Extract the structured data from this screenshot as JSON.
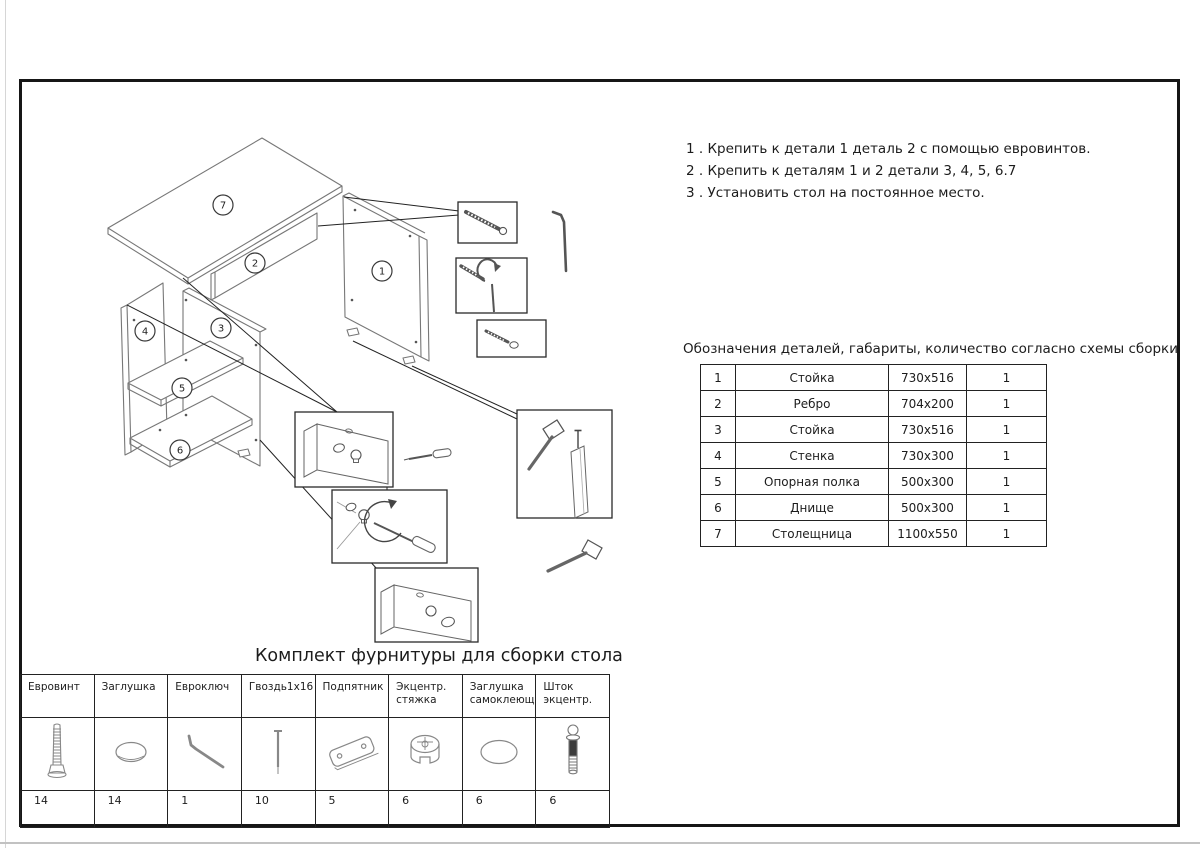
{
  "sheet": {
    "background": "#ffffff",
    "frame_color": "#161616"
  },
  "instructions": {
    "steps": [
      "1 . Крепить к детали 1 деталь 2 с помощью евровинтов.",
      "2 . Крепить к деталям 1 и 2 детали 3, 4, 5, 6.7",
      "3 . Установить стол на постоянное место."
    ]
  },
  "parts_table": {
    "title": "Обозначения деталей, габариты, количество согласно схемы сборки",
    "rows": [
      {
        "num": "1",
        "name": "Стойка",
        "size": "730x516",
        "qty": "1"
      },
      {
        "num": "2",
        "name": "Ребро",
        "size": "704x200",
        "qty": "1"
      },
      {
        "num": "3",
        "name": "Стойка",
        "size": "730x516",
        "qty": "1"
      },
      {
        "num": "4",
        "name": "Стенка",
        "size": "730x300",
        "qty": "1"
      },
      {
        "num": "5",
        "name": "Опорная полка",
        "size": "500x300",
        "qty": "1"
      },
      {
        "num": "6",
        "name": "Днище",
        "size": "500x300",
        "qty": "1"
      },
      {
        "num": "7",
        "name": "Столещница",
        "size": "1100x550",
        "qty": "1"
      }
    ]
  },
  "hardware_table": {
    "title": "Комплект фурнитуры для сборки стола",
    "columns": [
      {
        "label": "Евровинт",
        "icon": "euro-screw-icon",
        "qty": "14"
      },
      {
        "label": "Заглушка",
        "icon": "cap-icon",
        "qty": "14"
      },
      {
        "label": "Евроключ",
        "icon": "hex-key-icon",
        "qty": "1"
      },
      {
        "label": "Гвоздь1х16",
        "icon": "nail-icon",
        "qty": "10"
      },
      {
        "label": "Подпятник",
        "icon": "foot-pad-icon",
        "qty": "5"
      },
      {
        "label": "Экцентр.\nстяжка",
        "icon": "cam-lock-icon",
        "qty": "6"
      },
      {
        "label": "Заглушка\nсамоклеющ.",
        "icon": "adhesive-cap-icon",
        "qty": "6"
      },
      {
        "label": "Шток\nэкцентр.",
        "icon": "eccentric-rod-icon",
        "qty": "6"
      }
    ]
  },
  "diagram": {
    "part_numbers": [
      "1",
      "2",
      "3",
      "4",
      "5",
      "6",
      "7"
    ]
  }
}
